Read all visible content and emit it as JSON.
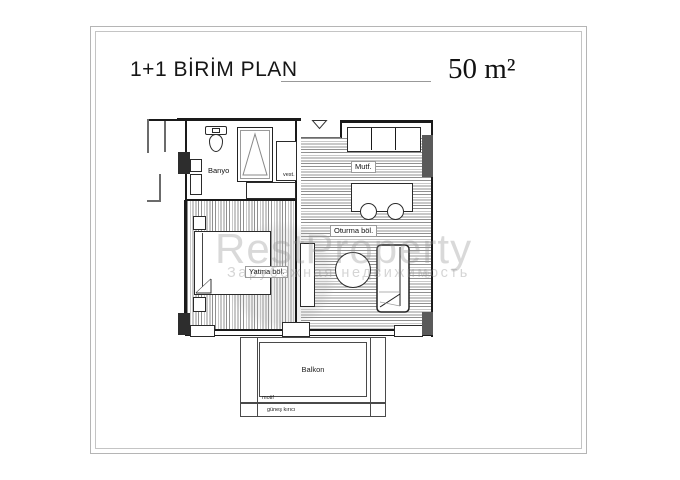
{
  "header": {
    "title": "1+1 BİRİM PLAN",
    "area": "50 m²"
  },
  "rooms": {
    "bathroom": "Banyo",
    "vestibule": "vest.",
    "kitchen": "Mutf.",
    "living": "Oturma böl.",
    "bedroom": "Yatma böl.",
    "balcony": "Balkon"
  },
  "annotations": {
    "motif": "motif",
    "sun_breaker": "güneş kırıcı"
  },
  "watermark": {
    "brand": "RestProperty",
    "tagline": "Зарубежная недвижимость",
    "registered": "®"
  },
  "colors": {
    "wall": "#1a1a1a",
    "hatch": "#909090",
    "column_black": "#2d2d2d",
    "column_gray": "#5a5a5a",
    "frame": "#b5b5b5",
    "watermark": "#969696"
  }
}
